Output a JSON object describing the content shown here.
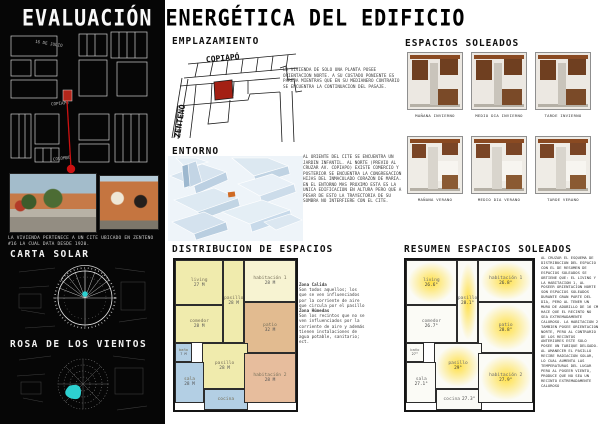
{
  "title": "EVALUACIÓN ENERGÉTICA DEL EDIFICIO",
  "sidebar": {
    "map_street_top": "16 DE JULIO",
    "map_street_mid": "COPIAPO",
    "map_street_bottom": "COLOMBO",
    "photo_caption": "LA VIVIENDA PERTENECE A UN CITE UBICADO EN ZENTENO #16 LA CUAL DATA DESDE 1920.",
    "carta_solar_title": "CARTA SOLAR",
    "rosa_vientos_title": "ROSA DE LOS VIENTOS"
  },
  "emplazamiento": {
    "title": "EMPLAZAMIENTO",
    "street_top": "COPIAPÓ",
    "street_left": "ZENTENO",
    "note": "LA VIVIENDA DE SOLO UNA PLANTA POSEE ORIENTACION NORTE. A SU COSTADO PONIENTE ES PAREJA MIENTRAS QUE EN SU MEDIANERO CONTRARIO SE ENCUENTRA LA CONTINUACION DEL PASAJE."
  },
  "entorno": {
    "title": "ENTORNO",
    "note": "AL ORIENTE DEL CITE SE ENCUENTRA UN JARDIN INFANTIL. AL NORTE (PREVIO AL CRUZAR AV. COPIAPO) EXISTE COMERCIO Y POSTERIOR SE ENCUENTRA LA CONGREGACION HIJAS DEL INMACULADO CORAZON DE MARIA. EN EL ENTORNO MAS PROXIMO ESTA ES LA UNICA EDIFICACION EN ALTURA PERO QUE A PESAR DE ESTO LA TRAYECTORIA DE SU SOMBRA NO INTERFIERE CON EL CITE."
  },
  "espacios_soleados": {
    "title": "ESPACIOS SOLEADOS",
    "captions": [
      "MAÑANA INVIERNO",
      "MEDIO DIA INVIERNO",
      "TARDE INVIERNO",
      "MAÑANA VERANO",
      "MEDIO DIA VERANO",
      "TARDE VERANO"
    ]
  },
  "distribucion": {
    "title": "DISTRIBUCION DE ESPACIOS",
    "rooms": [
      {
        "name": "living",
        "area": "27 M"
      },
      {
        "name": "habitación 1",
        "area": "28 M"
      },
      {
        "name": "comedor",
        "area": "28 M"
      },
      {
        "name": "pasillo",
        "area": "28 M"
      },
      {
        "name": "patio",
        "area": "32 M"
      },
      {
        "name": "baño",
        "area": "7 M"
      },
      {
        "name": "pasillo",
        "area": "28 M"
      },
      {
        "name": "sala",
        "area": "28 M"
      },
      {
        "name": "cocina",
        "area": ""
      },
      {
        "name": "habitación 2",
        "area": "28 M"
      }
    ],
    "legend": {
      "calida_title": "Zona Calida",
      "calida_body": "Son todos aquellos; los que se ven influenciados por la corriente de aire que circula por el pasillo",
      "humeda_title": "Zona Húmedas",
      "humeda_body": "Son los recintos que no se ven influenciados por la corriente de aire y además tienen instalaciones de agua potable, sanitario; ect."
    }
  },
  "resumen": {
    "title": "RESUMEN ESPACIOS SOLEADOS",
    "rooms": [
      {
        "name": "living",
        "temp": "26.6°"
      },
      {
        "name": "habitación 1",
        "temp": "26.8°"
      },
      {
        "name": "comedor",
        "temp": "26.7°"
      },
      {
        "name": "pasillo",
        "temp": "28.1°"
      },
      {
        "name": "patio",
        "temp": "28.8°"
      },
      {
        "name": "baño",
        "temp": "27°"
      },
      {
        "name": "pasillo",
        "temp": "29°"
      },
      {
        "name": "sala",
        "temp": "27.1°"
      },
      {
        "name": "cocina",
        "temp": "27.3°"
      },
      {
        "name": "habitación 2",
        "temp": "27.9°"
      }
    ],
    "analysis": "AL CRUZAR EL ESQUEMA DE DISTRIBUCION DEL ESPACIO CON EL DE RESUMEN DE ESPACIOS SOLEADOS SE OBTIENE QUE: EL LIVING Y LA HABITACION 1, AL POSEER ORIENTACION NORTE SON ESPACIOS SOLEADOS DURANTE GRAN PARTE DEL DIA, PERO AL TENER UN MURO DE ADOBILLO DE 16 CM HACE QUE EL RECINTO NO SEA EXTREMADAMENTE CALUROSO. LA HABITACION 2 TAMBIEN POSEE ORIENTACION NORTE, PERO AL CONTRARIO DE LOS RECINTOS ANTERIORES ESTE SOLO POSEE UN TABIQUE DELGADO. AL AMANECER EL PASILLO RECIBE RADIACION SOLAR, LO CUAL AUMENTA LAS TEMPERATURAS DEL LUGAR PERO AL POSEER VIENTO, PRODUCE QUE NO SEA UN RECINTO EXTREMADAMENTE CALUROSO"
  },
  "colors": {
    "accent_red": "#b3261a",
    "accent_cyan": "#2dd0d0",
    "glow_yellow": "#ffde3c",
    "zone_warm": "#f0ebad",
    "zone_humid": "#b3cfe4",
    "zone_patio": "#e2bb90"
  }
}
